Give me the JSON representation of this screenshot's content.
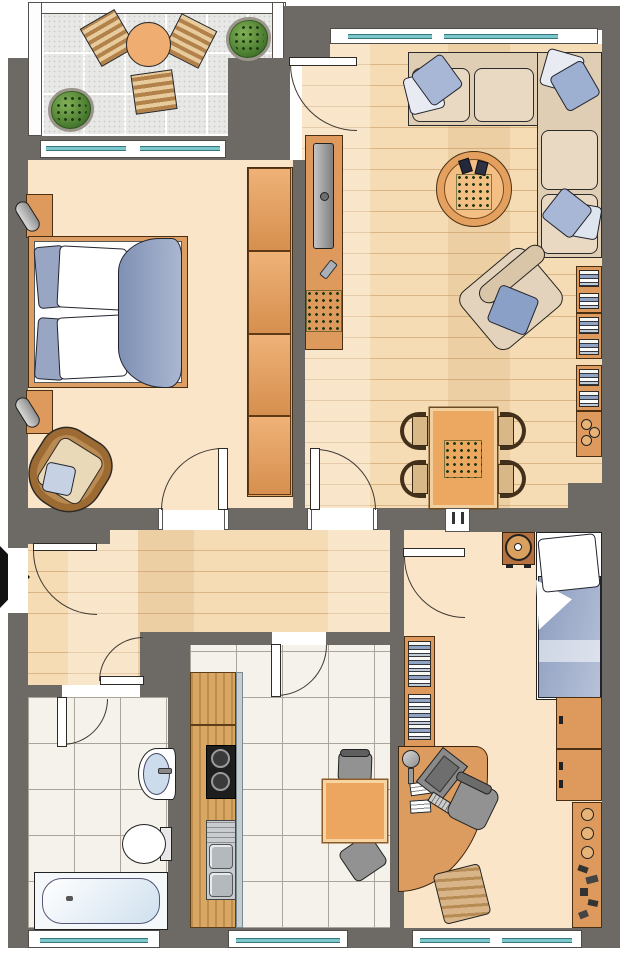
{
  "app": {
    "name": "apartment-floor-plan",
    "type": "architectural-floor-plan",
    "visible_text": ""
  },
  "palette": {
    "wall": "#6d6a66",
    "wood_floor": "#f6dcb4",
    "room_floor": "#fbe5c9",
    "tile_floor": "#f5f2eb",
    "balcony_tile": "#e8e8e6",
    "furniture_wood": "#dd9a5c",
    "wardrobe_wood": "#e2a263",
    "counter_wood": "#d8a763",
    "textile_blue": "#93a3c4",
    "pillow_light": "#e8ecf2",
    "window_glass": "#7cc7cb",
    "plant_green": "#4a7c30",
    "appliance_gray": "#929292",
    "entry_arrow": "#111111"
  },
  "rooms": [
    {
      "id": "balcony",
      "name": "Balcony",
      "floor": "gray-tiles",
      "furniture": [
        "round-bistro-table",
        "slat-chair",
        "slat-chair",
        "slat-chair",
        "potted-plant",
        "potted-plant"
      ]
    },
    {
      "id": "living-room",
      "name": "Living Room",
      "floor": "wood-planks",
      "furniture": [
        "corner-sofa",
        "throw-pillows",
        "round-coffee-table",
        "coffee-table-plant",
        "remote-controls",
        "tv-sideboard",
        "television",
        "remote-control",
        "houseplant",
        "armchair",
        "armchair-pillow",
        "wall-bookshelf",
        "lowboard-with-bowls",
        "dining-table",
        "dining-table-plant",
        "dining-chair",
        "dining-chair",
        "dining-chair",
        "dining-chair"
      ]
    },
    {
      "id": "bedroom",
      "name": "Bedroom",
      "floor": "plain",
      "furniture": [
        "double-bed",
        "pillows",
        "duvet",
        "nightstand-top",
        "table-lamp",
        "nightstand-bottom",
        "table-lamp",
        "wardrobe",
        "wicker-armchair",
        "seat-cushion"
      ]
    },
    {
      "id": "hallway",
      "name": "Hallway",
      "floor": "wood-planks",
      "furniture": []
    },
    {
      "id": "bathroom",
      "name": "Bathroom",
      "floor": "white-tiles",
      "furniture": [
        "washbasin",
        "toilet",
        "bathtub"
      ]
    },
    {
      "id": "kitchen",
      "name": "Kitchen",
      "floor": "white-tiles",
      "furniture": [
        "kitchen-counter",
        "upper-cabinet",
        "cooktop",
        "double-sink",
        "square-table",
        "chair",
        "chair"
      ]
    },
    {
      "id": "kids-room",
      "name": "Kids Room",
      "floor": "plain",
      "furniture": [
        "single-bed",
        "pillow",
        "duvet",
        "nightstand-with-clock",
        "dresser",
        "shelf-with-bowls",
        "toy-shelf",
        "wall-bookshelf",
        "corner-desk",
        "monitor",
        "keyboard",
        "papers",
        "desk-lamp",
        "office-chair",
        "wooden-chair"
      ]
    }
  ],
  "doors": [
    "entry-door",
    "balcony-door",
    "bedroom-door",
    "living-room-door",
    "kids-room-door",
    "kitchen-door",
    "bathroom-door"
  ],
  "windows": [
    "living-room-north-window",
    "bedroom-north-window",
    "bathroom-south-window",
    "kitchen-south-window",
    "kids-room-south-window"
  ],
  "entrance": {
    "symbol": "entry-arrow",
    "direction": "right"
  }
}
